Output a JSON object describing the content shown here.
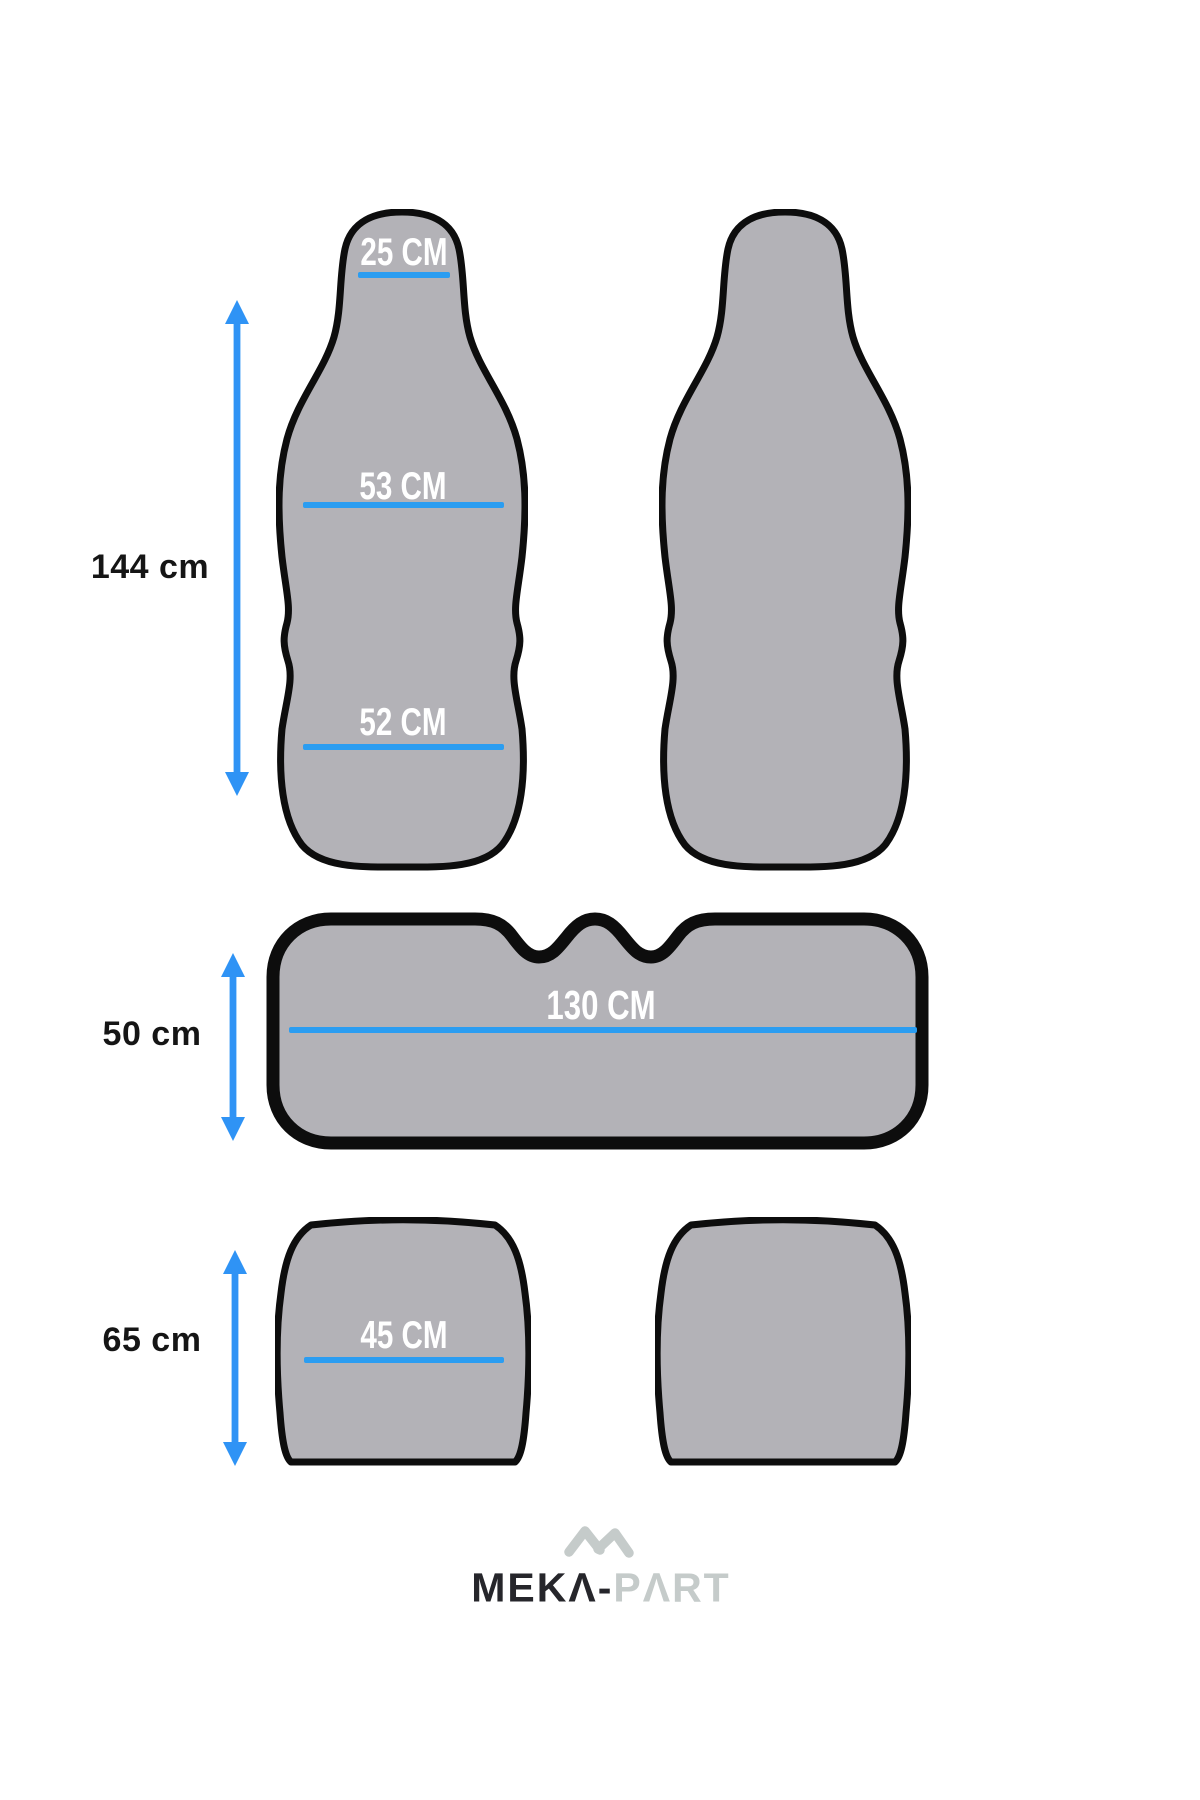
{
  "diagram": {
    "title_hint": "car seat cover size diagram",
    "front_seat_cover": {
      "headrest_width": "25 CM",
      "backrest_width": "53 CM",
      "cushion_width": "52 CM",
      "total_height": "144 cm"
    },
    "rear_bench_cover": {
      "width": "130 CM",
      "height": "50 cm"
    },
    "bottom_cushion_cover": {
      "width": "45 CM",
      "height": "65 cm"
    }
  },
  "logo": {
    "brand": "MEKA-PART",
    "text_dark": "MEKΛ-",
    "text_light": "PΛRT"
  },
  "colors": {
    "shape_fill": "#b3b2b7",
    "shape_outline": "#0d0d0d",
    "measure_line_blue": "#2b9df1",
    "arrow_blue": "#2f93f5",
    "label_black": "#151515",
    "logo_dark": "#26262b",
    "logo_light": "#c5cbca",
    "background": "#ffffff"
  }
}
